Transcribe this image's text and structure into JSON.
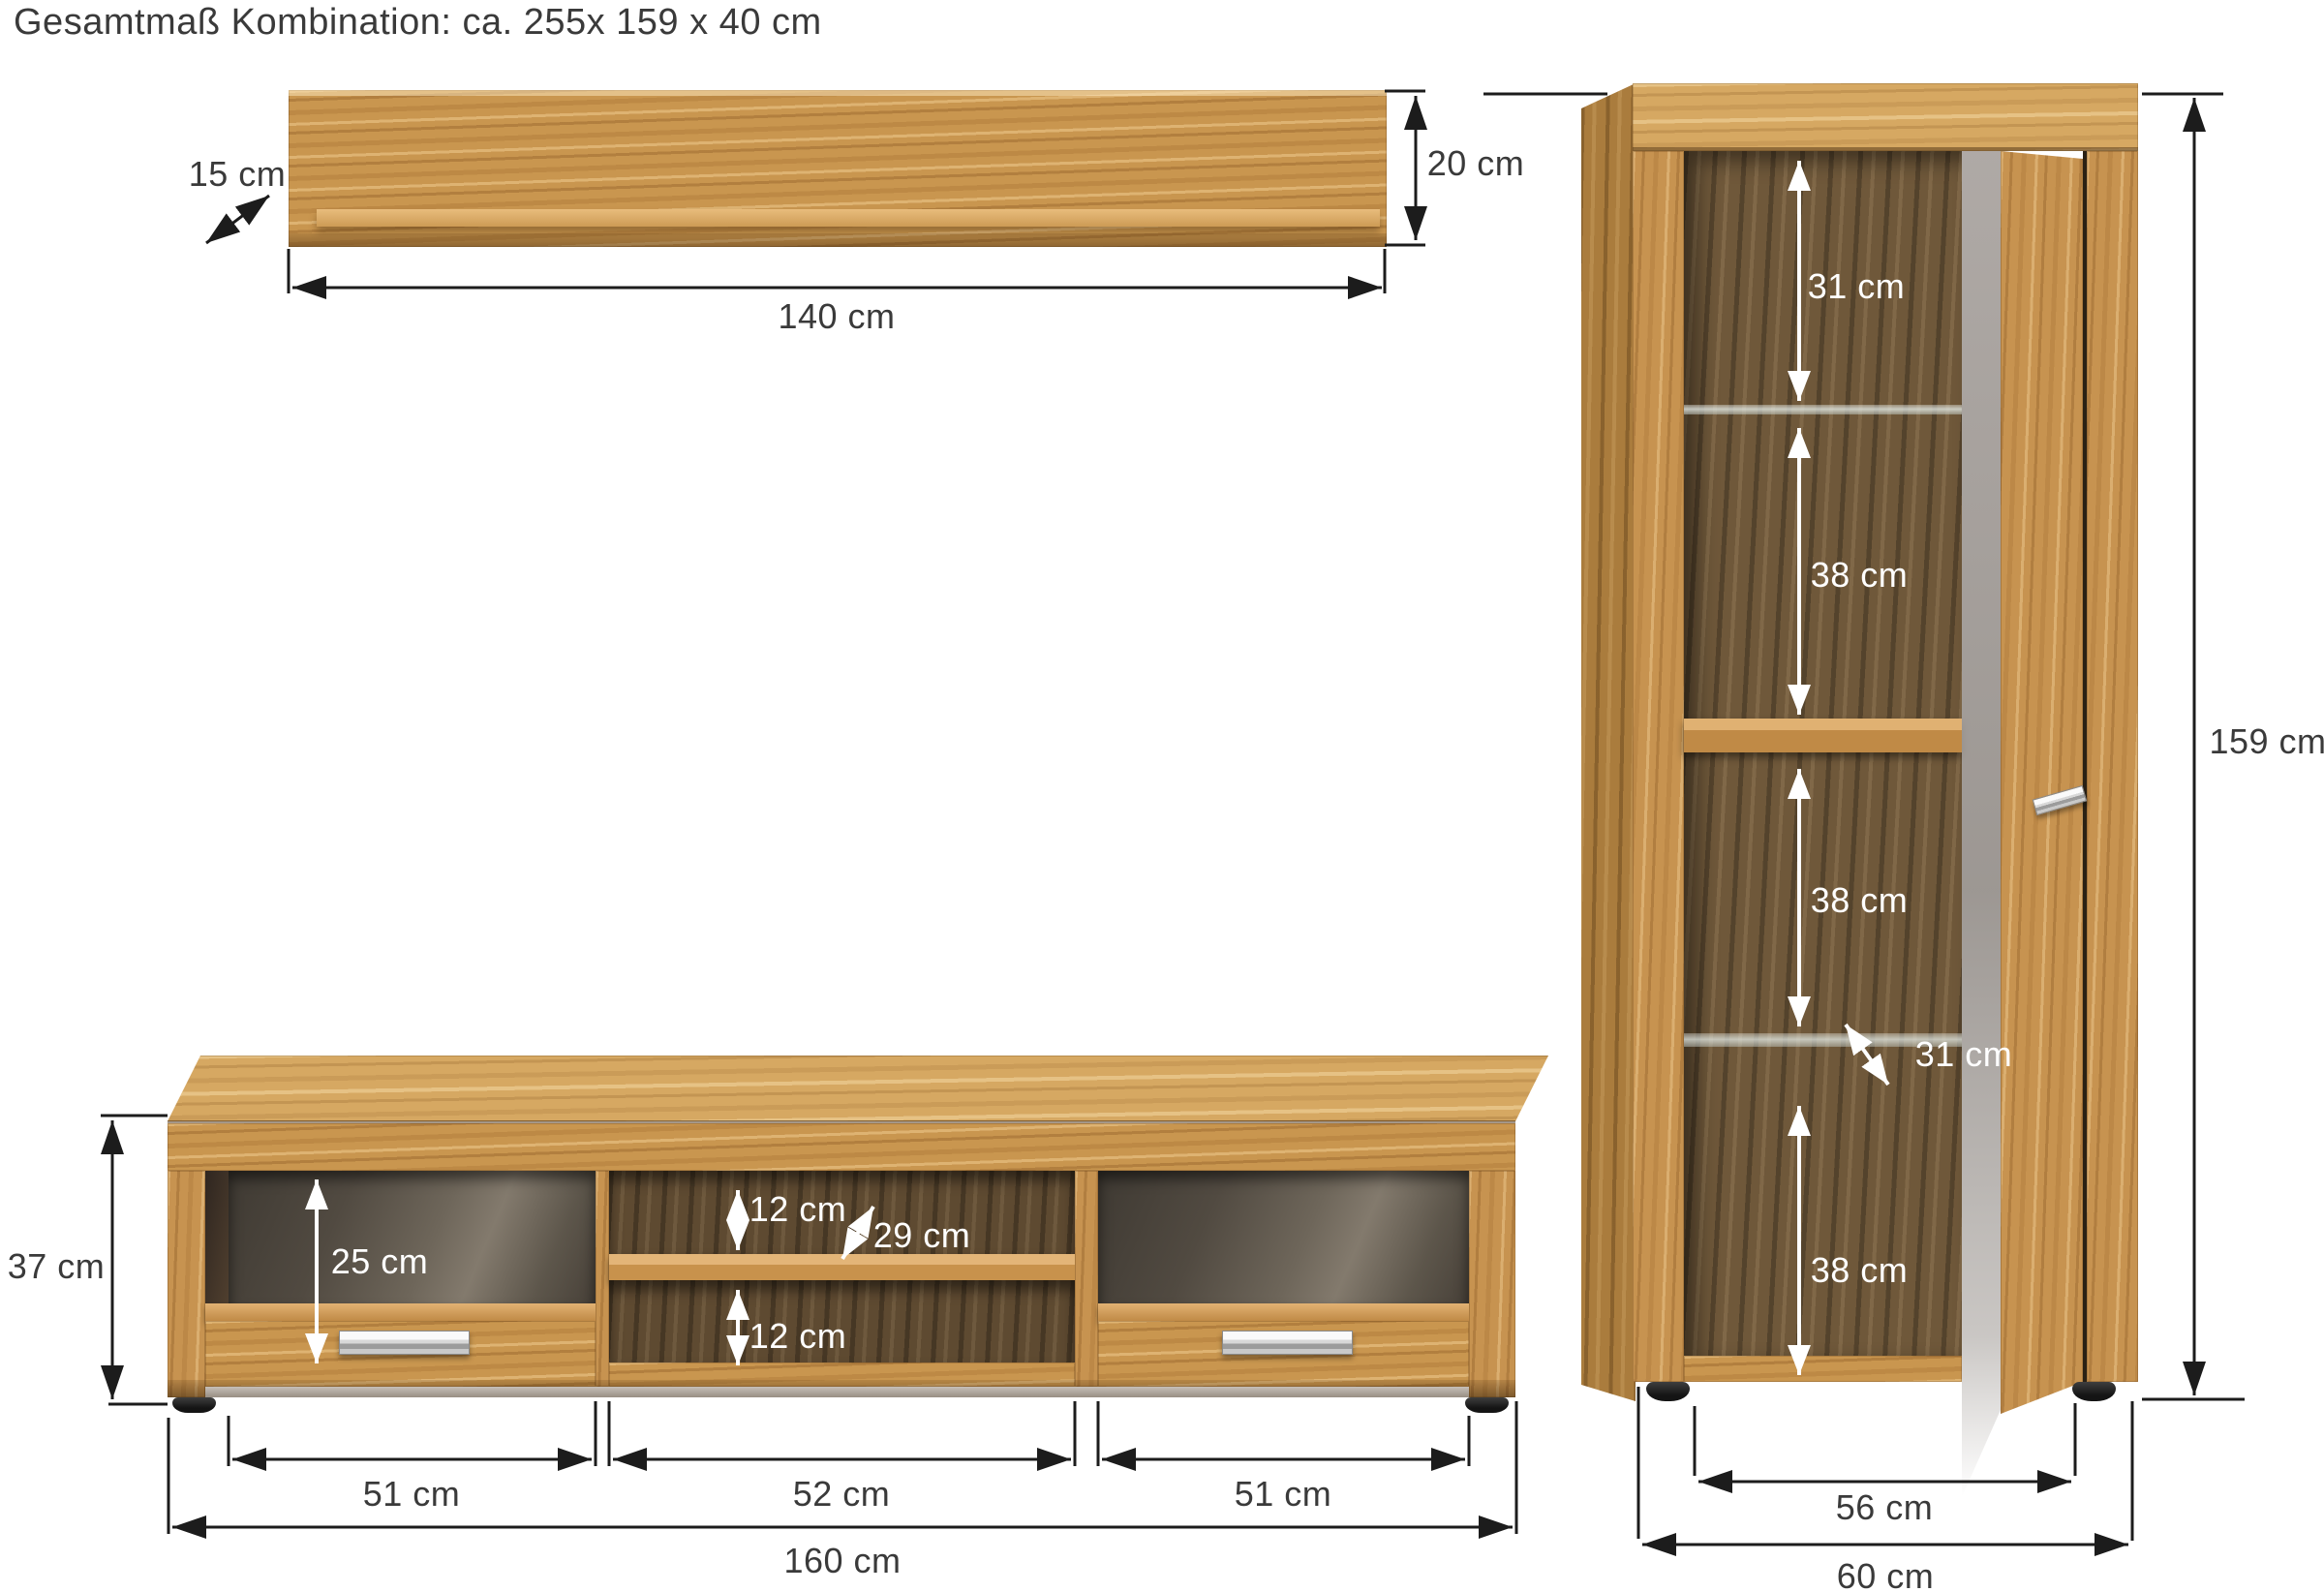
{
  "title": "Gesamtmaß Kombination: ca. 255x 159 x 40 cm",
  "wall_shelf": {
    "depth_label": "15 cm",
    "height_label": "20 cm",
    "width_label": "140 cm"
  },
  "lowboard": {
    "height_label": "37 cm",
    "compartment_height_label": "25 cm",
    "top_gap_label": "12 cm",
    "shelf_depth_label": "29 cm",
    "bottom_gap_label": "12 cm",
    "left_compartment_label": "51 cm",
    "middle_compartment_label": "52 cm",
    "right_compartment_label": "51 cm",
    "width_label": "160 cm"
  },
  "cabinet": {
    "top_section_label": "31 cm",
    "upper_section_label": "38 cm",
    "middle_section_label": "38 cm",
    "glass_shelf_depth_label": "31 cm",
    "bottom_section_label": "38 cm",
    "height_label": "159 cm",
    "inner_width_label": "56 cm",
    "width_label": "60 cm"
  }
}
